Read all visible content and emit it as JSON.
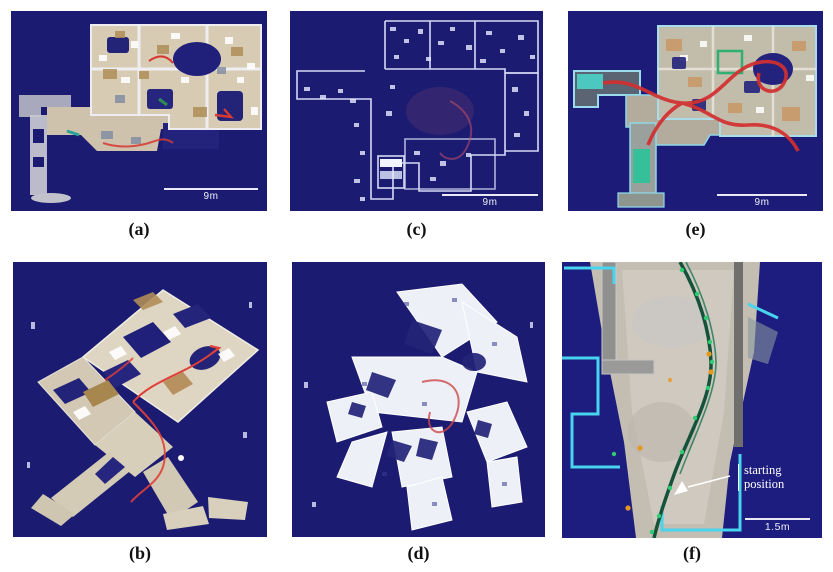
{
  "figure": {
    "panels": [
      {
        "id": "a",
        "label": "(a)",
        "scale_label": "9m"
      },
      {
        "id": "c",
        "label": "(c)",
        "scale_label": "9m"
      },
      {
        "id": "e",
        "label": "(e)",
        "scale_label": "9m"
      },
      {
        "id": "b",
        "label": "(b)"
      },
      {
        "id": "d",
        "label": "(d)"
      },
      {
        "id": "f",
        "label": "(f)",
        "scale_label": "1.5m",
        "annotation": {
          "line1": "starting",
          "line2": "position"
        }
      }
    ],
    "colors": {
      "page_background": "#ffffff",
      "panel_background": "#1b1b72",
      "trajectory_red": "#d63a32",
      "trajectory_green_dark": "#14523c",
      "trajectory_green_bright": "#2ecc71",
      "outline_cyan": "#48d4ec",
      "map_surface_cream": "#d8cbb4",
      "point_cloud_white": "#eef0f8",
      "scale_bar_white": "#e9e9f6",
      "annotation_text": "#ffffff"
    }
  }
}
